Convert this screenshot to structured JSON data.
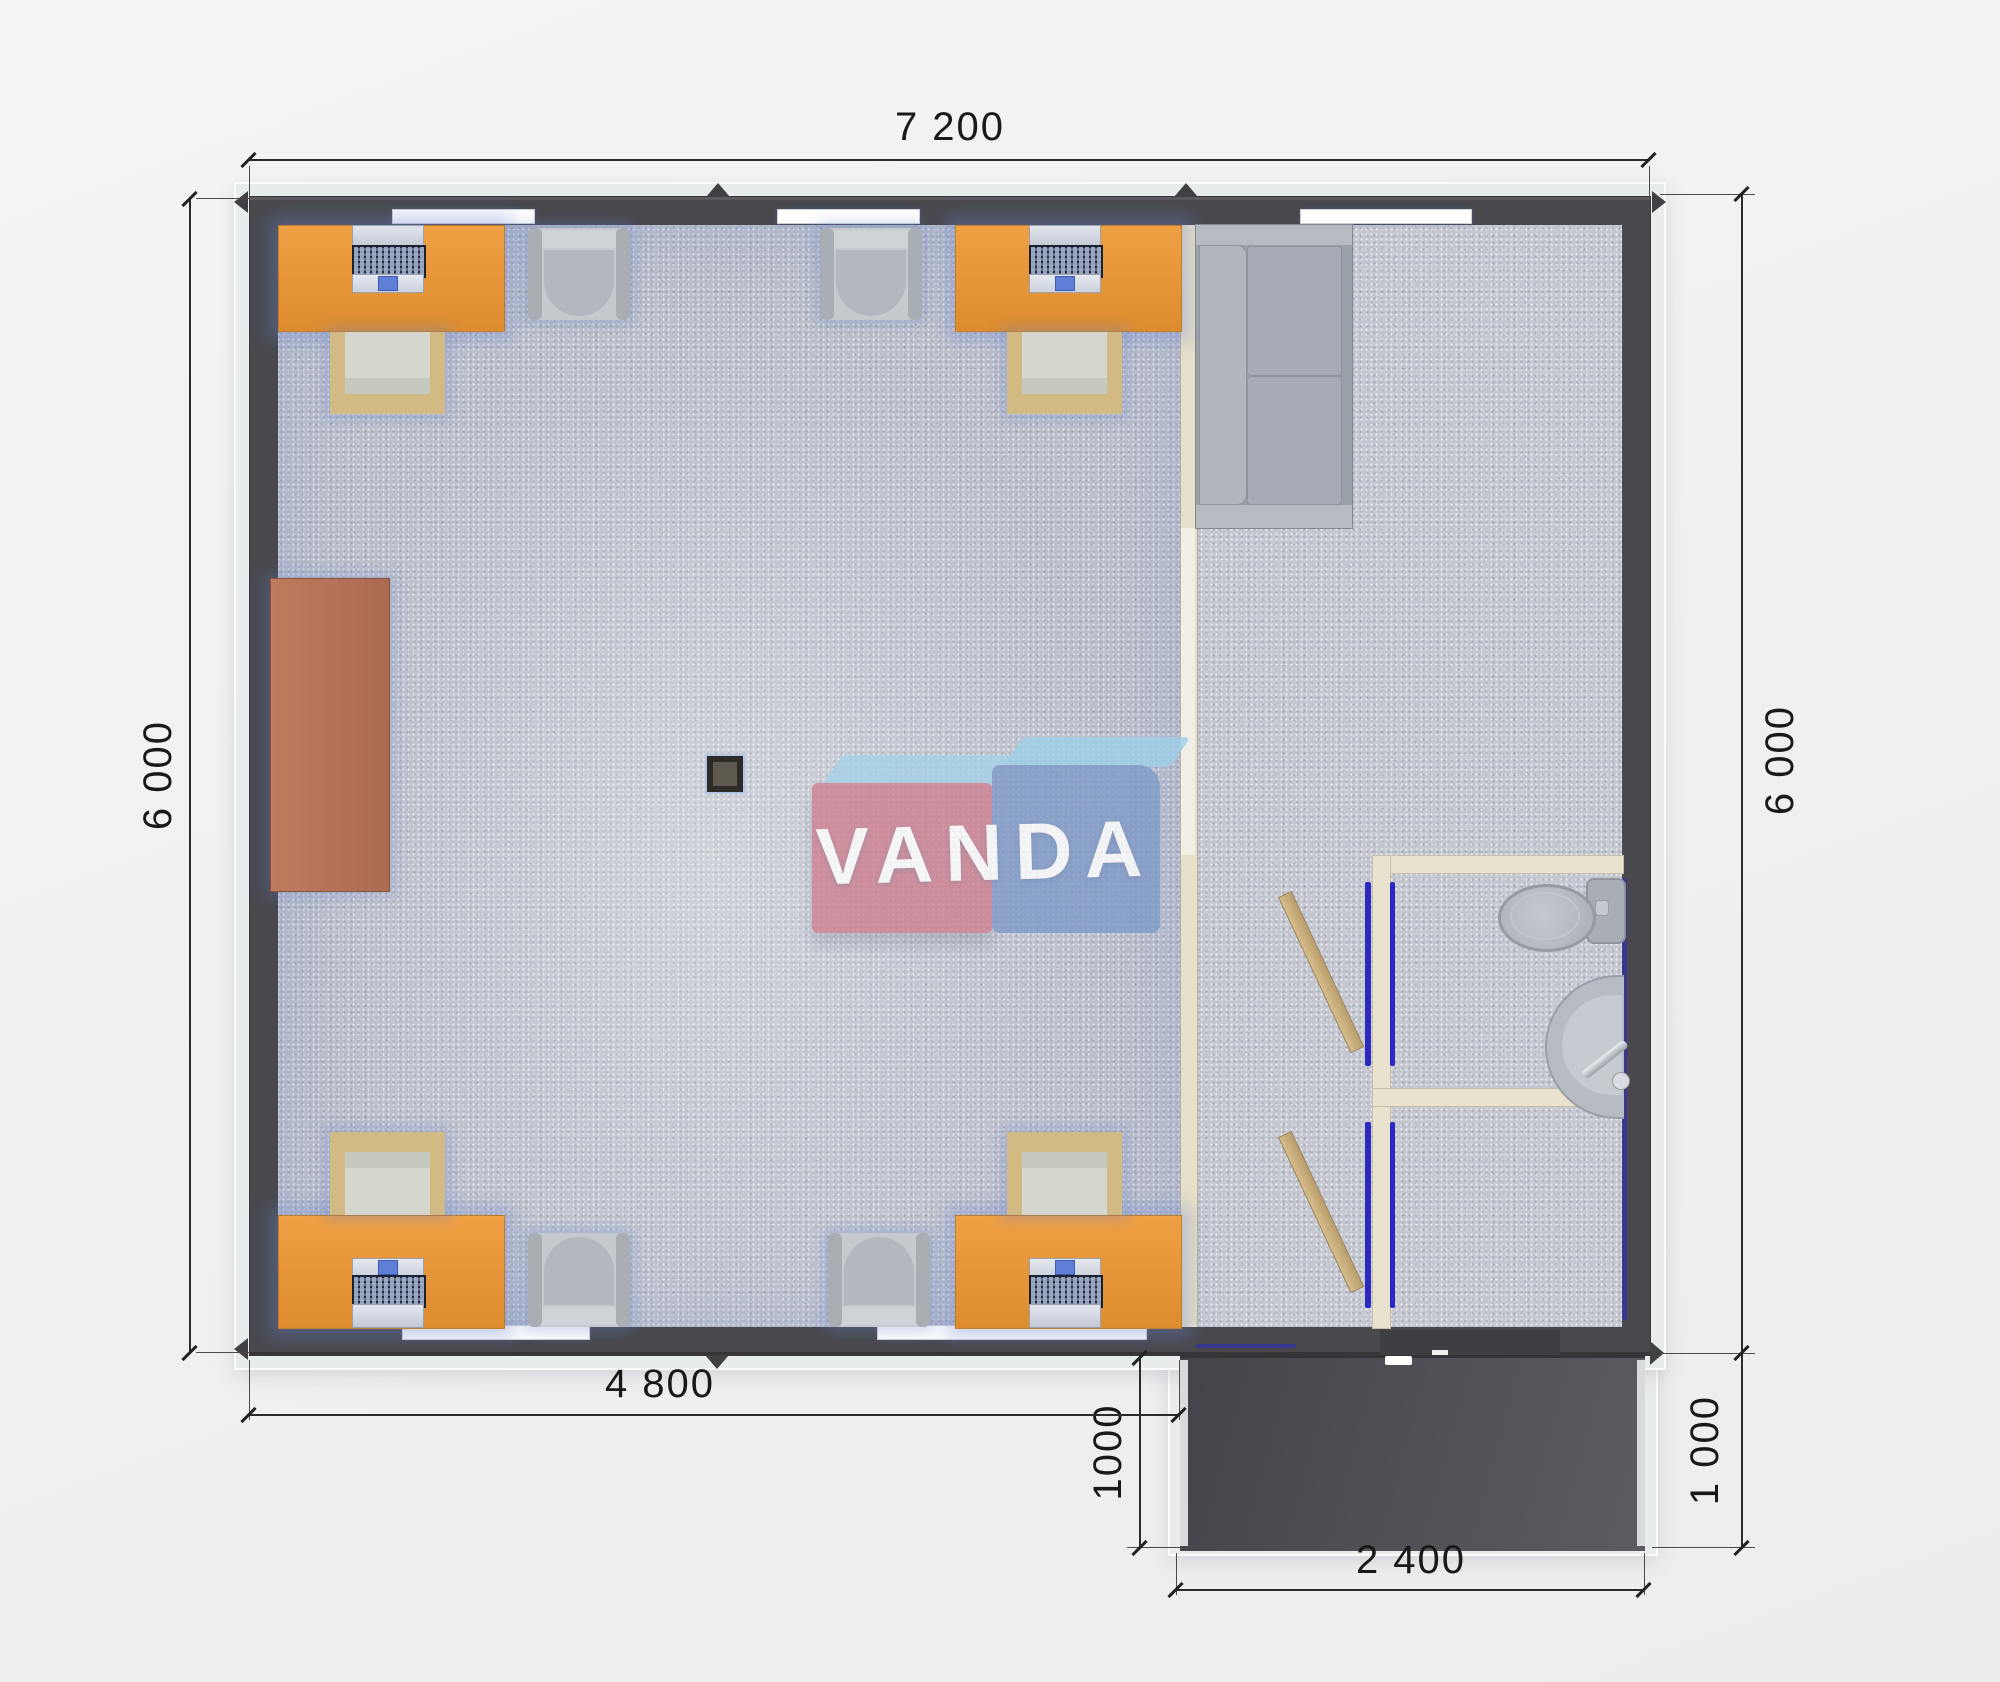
{
  "watermark": {
    "text": "VANDA"
  },
  "dimensions": {
    "top_width": "7 200",
    "left_height": "6 000",
    "right_height": "6 000",
    "inner_width": "4 800",
    "porch_height_left": "1000",
    "porch_height_right": "1 000",
    "porch_width": "2 400"
  },
  "colors": {
    "wall_dark": "#48484d",
    "floor_office": "#bcc0cb",
    "floor_hall": "#c5c8d1",
    "desk_orange": "#e8923a",
    "sideboard_brown": "#b5735a",
    "partition_beige": "#e6dfc9",
    "door_tan": "#c9ae7c",
    "door_frame_blue": "#2a2ac2",
    "porch_dark": "#4f4f54",
    "sofa_gray": "#a8adb5",
    "watermark_red": "#cf8190",
    "watermark_blue": "#7f9ac8",
    "watermark_topface": "#a4d2e8",
    "dimension_text": "#191919"
  }
}
